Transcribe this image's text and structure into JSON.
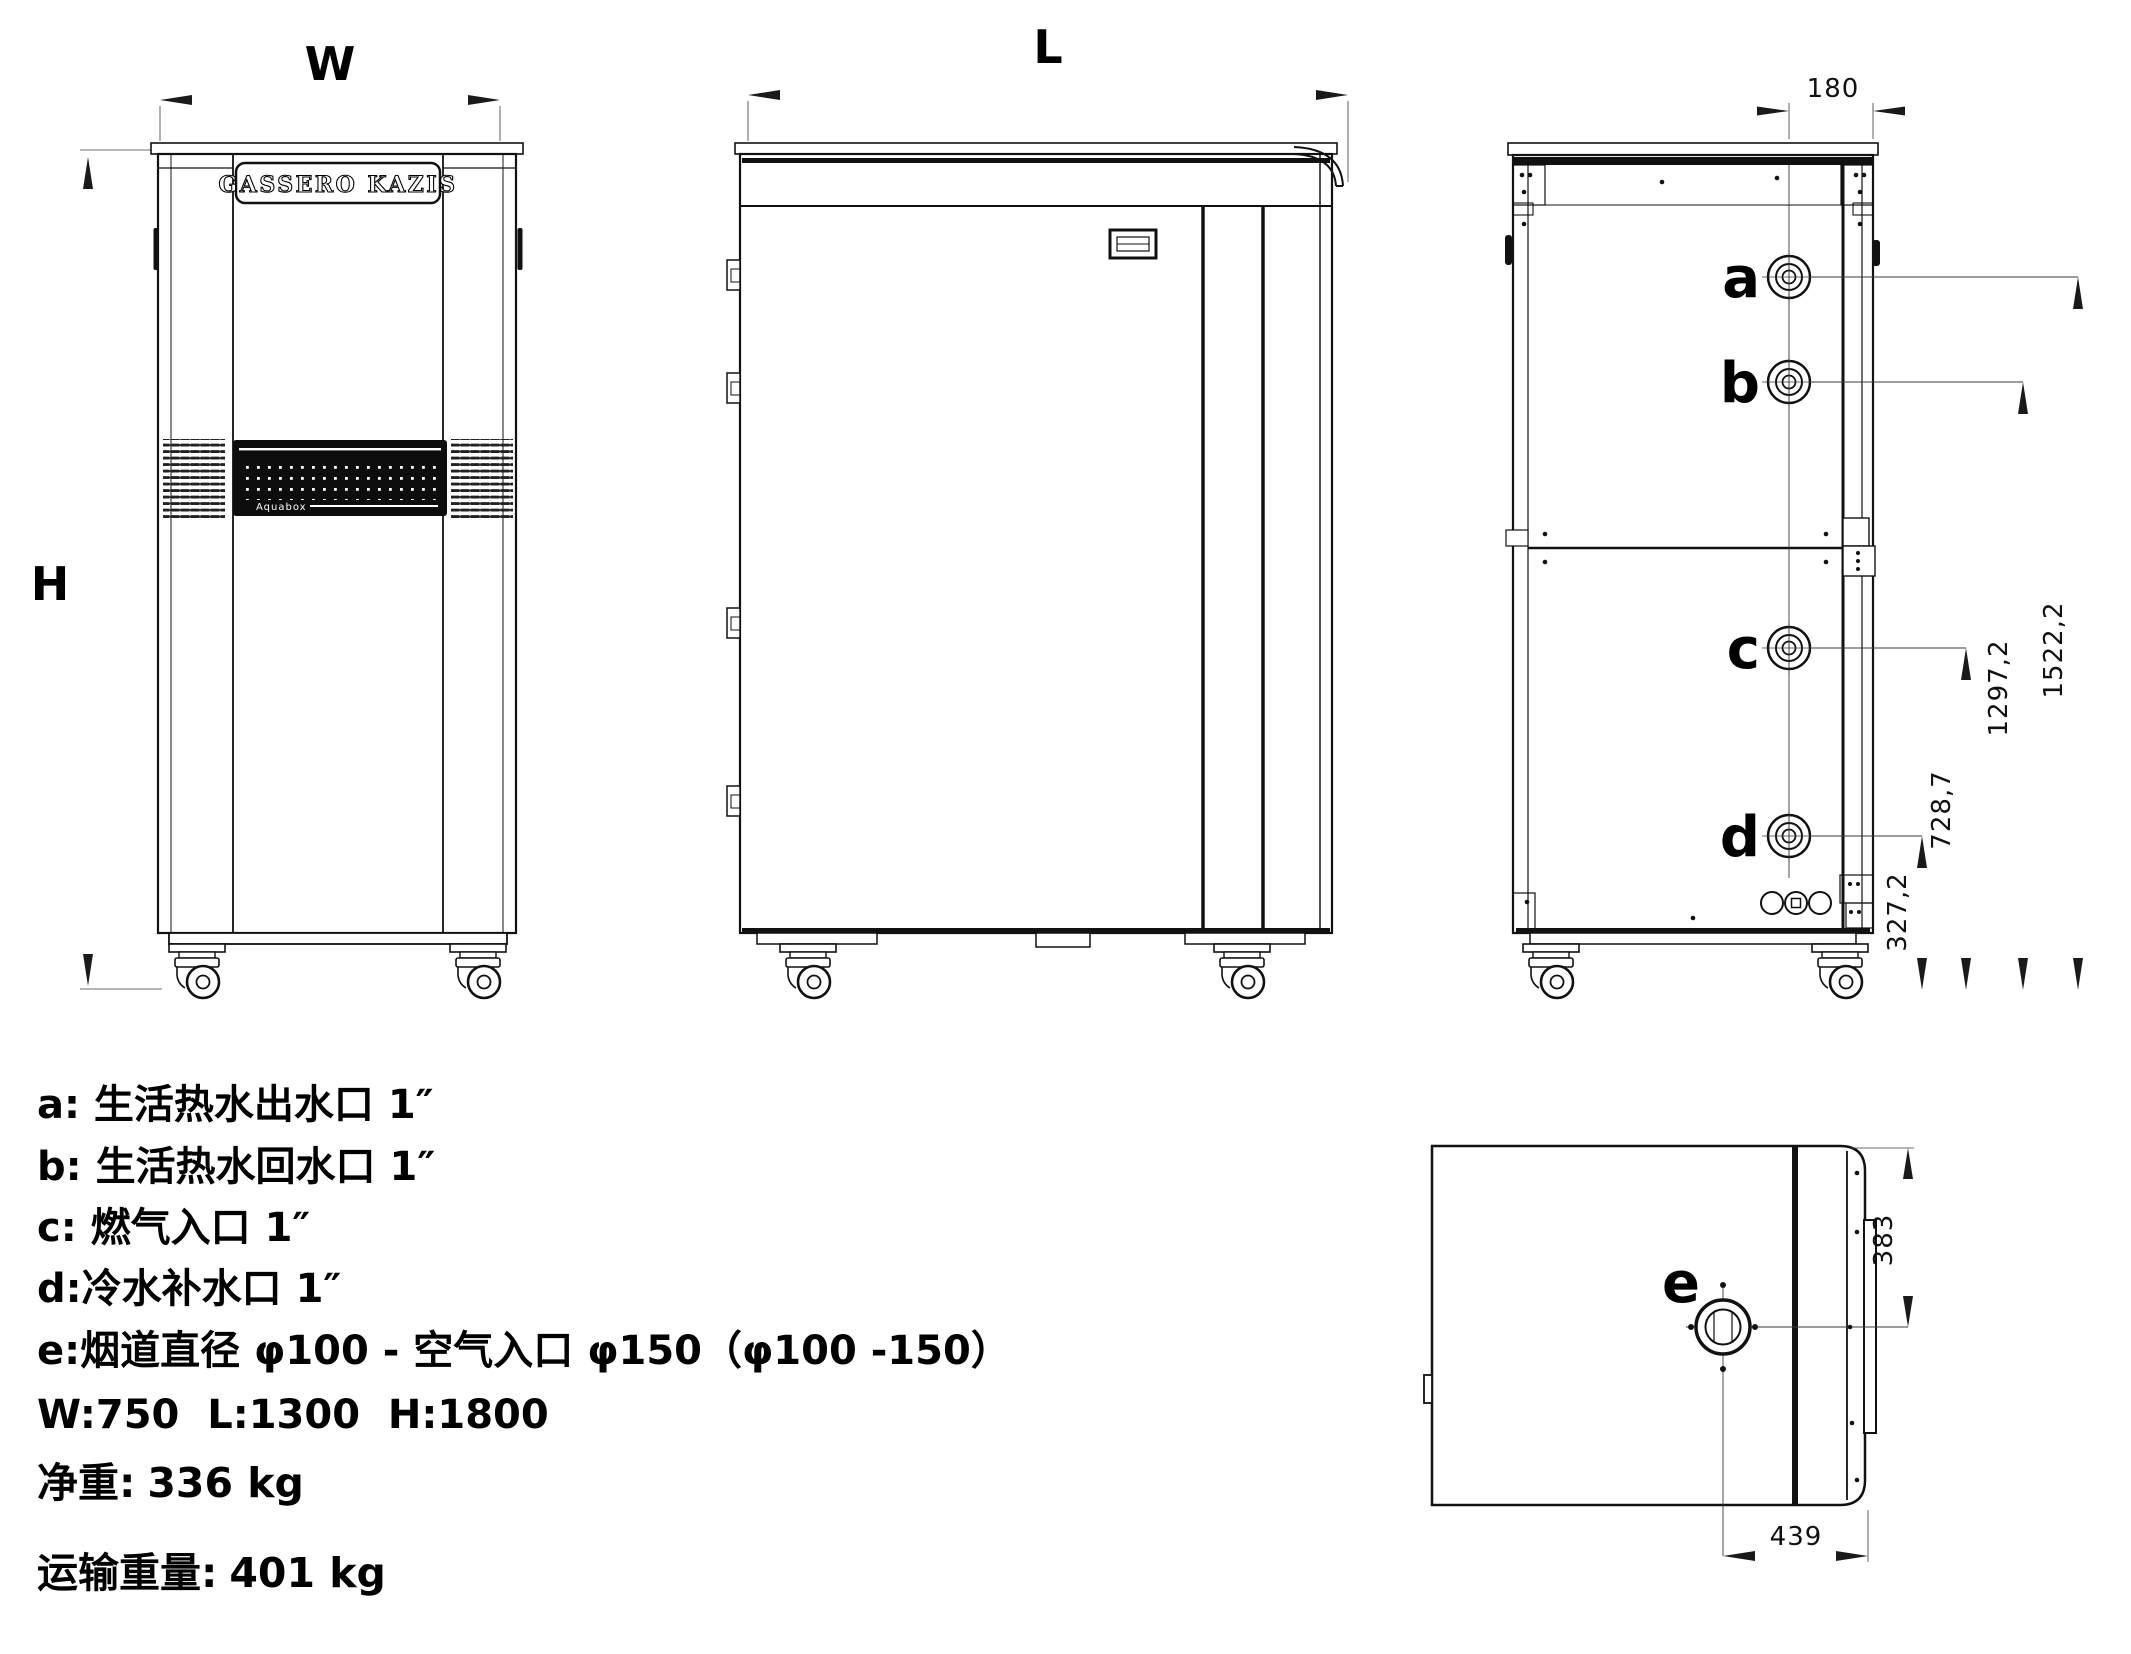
{
  "views": {
    "front": {
      "width_label": "W",
      "height_label": "H",
      "brand_plate": "GASSERO KAZIS",
      "panel_logo": "Aquabox"
    },
    "side": {
      "length_label": "L"
    },
    "rear": {
      "offset_dim": "180",
      "ports": {
        "a": "a",
        "b": "b",
        "c": "c",
        "d": "d"
      },
      "height_dims": {
        "a": "1522,2",
        "b": "1297,2",
        "c": "728,7",
        "d": "327,2"
      }
    },
    "top": {
      "port_e": "e",
      "dim_side": "383",
      "dim_bottom": "439"
    }
  },
  "legend": {
    "a_key": "a: ",
    "a_text": "生活热水出水口 1″",
    "b_key": "b: ",
    "b_text": "生活热水回水口 1″",
    "c_key": "c: ",
    "c_text": "燃气入口 1″",
    "d_key": "d:",
    "d_text": "冷水补水口 1″",
    "e_key": "e:",
    "e_text": "烟道直径 φ100 - 空气入口 φ150（φ100 -150）",
    "dims_line": "W:750  L:1300  H:1800",
    "net_weight_label": "净重:",
    "net_weight_value": "336 kg",
    "ship_weight_label": "运输重量:",
    "ship_weight_value": "401 kg"
  }
}
